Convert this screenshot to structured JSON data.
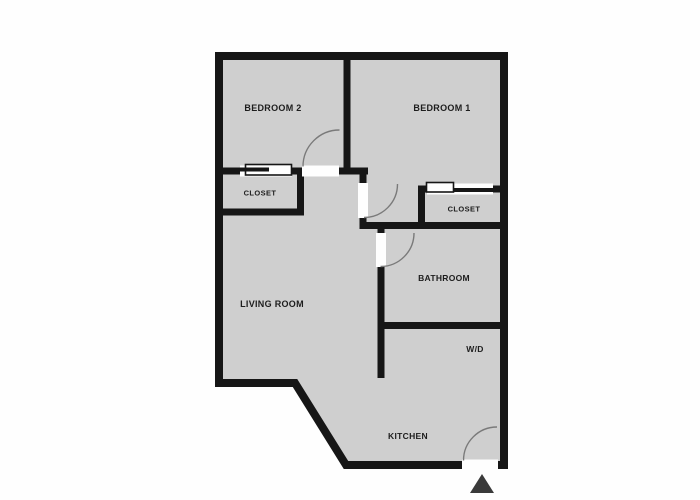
{
  "rooms": {
    "bedroom2": {
      "label": "BEDROOM 2"
    },
    "bedroom1": {
      "label": "BEDROOM 1"
    },
    "closet_bedroom2": {
      "label": "CLOSET"
    },
    "closet_bedroom1": {
      "label": "CLOSET"
    },
    "living_room": {
      "label": "LIVING ROOM"
    },
    "bathroom": {
      "label": "BATHROOM"
    },
    "washer_dryer": {
      "label": "W/D"
    },
    "kitchen": {
      "label": "KITCHEN"
    }
  },
  "icons": {
    "entrance_marker": "entrance-triangle"
  },
  "colors": {
    "background": "#fefefe",
    "floor": "#cfcfcf",
    "wall": "#161616",
    "door_arc": "#7a7a7a",
    "label_text": "#1d1d1d",
    "entrance_marker": "#3a3a3a"
  }
}
